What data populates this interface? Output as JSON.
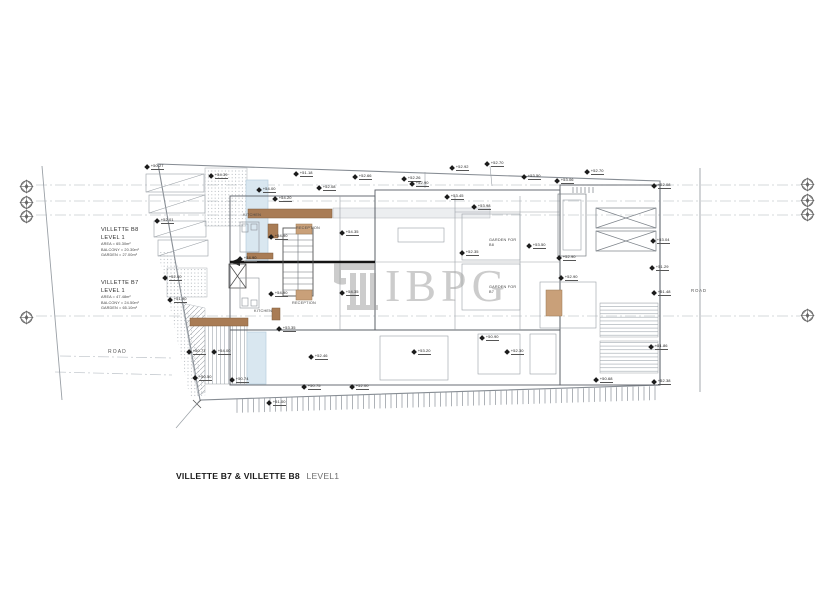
{
  "title": {
    "project": "VILLETTE B7 & VILLETTE B8",
    "level": "LEVEL1"
  },
  "watermark": {
    "text": "IBPG"
  },
  "roads": {
    "left": "ROAD",
    "right": "ROAD"
  },
  "units": [
    {
      "name": "VILLETTE B8",
      "level": "LEVEL 1",
      "details": [
        "AREA = 65.30m²",
        "BALCONY = 20.30m²",
        "GARDEN = 27.00m²"
      ]
    },
    {
      "name": "VILLETTE B7",
      "level": "LEVEL 1",
      "details": [
        "AREA = 47.48m²",
        "BALCONY = 24.50m²",
        "GARDEN = 65.10m²"
      ]
    }
  ],
  "room_labels": [
    {
      "label": "KITCHEN",
      "x": 243,
      "y": 213
    },
    {
      "label": "RECEPTION",
      "x": 296,
      "y": 226
    },
    {
      "label": "RECEPTION",
      "x": 292,
      "y": 301
    },
    {
      "label": "KITCHEN",
      "x": 254,
      "y": 309
    },
    {
      "label": "GARDEN FOR",
      "line2": "B8",
      "x": 489,
      "y": 238
    },
    {
      "label": "GARDEN FOR",
      "line2": "B7",
      "x": 489,
      "y": 285
    }
  ],
  "markers": [
    {
      "label": "+50.27",
      "x": 148,
      "y": 167
    },
    {
      "label": "+54.39",
      "x": 212,
      "y": 176
    },
    {
      "label": "+52.01",
      "x": 158,
      "y": 221
    },
    {
      "label": "+54.00",
      "x": 260,
      "y": 190
    },
    {
      "label": "+51.18",
      "x": 297,
      "y": 174
    },
    {
      "label": "+52.08",
      "x": 320,
      "y": 188
    },
    {
      "label": "+52.66",
      "x": 356,
      "y": 177
    },
    {
      "label": "+52.26",
      "x": 405,
      "y": 179
    },
    {
      "label": "+52.90",
      "x": 413,
      "y": 184
    },
    {
      "label": "+53.45",
      "x": 448,
      "y": 197
    },
    {
      "label": "+52.92",
      "x": 453,
      "y": 168
    },
    {
      "label": "+52.70",
      "x": 488,
      "y": 164
    },
    {
      "label": "+53.50",
      "x": 525,
      "y": 177
    },
    {
      "label": "+53.06",
      "x": 558,
      "y": 181
    },
    {
      "label": "+52.70",
      "x": 588,
      "y": 172
    },
    {
      "label": "+52.08",
      "x": 655,
      "y": 186
    },
    {
      "label": "+53.04",
      "x": 654,
      "y": 241
    },
    {
      "label": "+51.29",
      "x": 653,
      "y": 268
    },
    {
      "label": "+51.48",
      "x": 655,
      "y": 293
    },
    {
      "label": "+51.86",
      "x": 652,
      "y": 347
    },
    {
      "label": "+52.38",
      "x": 655,
      "y": 382
    },
    {
      "label": "+52.00",
      "x": 166,
      "y": 278
    },
    {
      "label": "+51.90",
      "x": 171,
      "y": 300
    },
    {
      "label": "+50.77",
      "x": 190,
      "y": 352
    },
    {
      "label": "+50.50",
      "x": 196,
      "y": 378
    },
    {
      "label": "+50.74",
      "x": 233,
      "y": 380
    },
    {
      "label": "+54.20",
      "x": 276,
      "y": 199
    },
    {
      "label": "+54.90",
      "x": 272,
      "y": 237
    },
    {
      "label": "+54.90",
      "x": 241,
      "y": 259
    },
    {
      "label": "+54.90",
      "x": 272,
      "y": 294
    },
    {
      "label": "+54.35",
      "x": 343,
      "y": 233
    },
    {
      "label": "+54.35",
      "x": 343,
      "y": 293
    },
    {
      "label": "+53.98",
      "x": 475,
      "y": 207
    },
    {
      "label": "+52.35",
      "x": 463,
      "y": 253
    },
    {
      "label": "+53.50",
      "x": 530,
      "y": 246
    },
    {
      "label": "+52.90",
      "x": 560,
      "y": 258
    },
    {
      "label": "+52.90",
      "x": 562,
      "y": 278
    },
    {
      "label": "+54.00",
      "x": 215,
      "y": 352
    },
    {
      "label": "+53.35",
      "x": 280,
      "y": 329
    },
    {
      "label": "+52.46",
      "x": 312,
      "y": 357
    },
    {
      "label": "+53.20",
      "x": 415,
      "y": 352
    },
    {
      "label": "+50.90",
      "x": 483,
      "y": 338
    },
    {
      "label": "+52.30",
      "x": 508,
      "y": 352
    },
    {
      "label": "+50.75",
      "x": 305,
      "y": 387
    },
    {
      "label": "+52.00",
      "x": 353,
      "y": 387
    },
    {
      "label": "+51.00",
      "x": 270,
      "y": 403
    },
    {
      "label": "+50.68",
      "x": 597,
      "y": 380
    }
  ],
  "benchmarks": [
    {
      "x": 26,
      "y": 186
    },
    {
      "x": 26,
      "y": 202
    },
    {
      "x": 26,
      "y": 216
    },
    {
      "x": 26,
      "y": 317
    },
    {
      "x": 807,
      "y": 184
    },
    {
      "x": 807,
      "y": 200
    },
    {
      "x": 807,
      "y": 214
    },
    {
      "x": 807,
      "y": 315
    }
  ]
}
